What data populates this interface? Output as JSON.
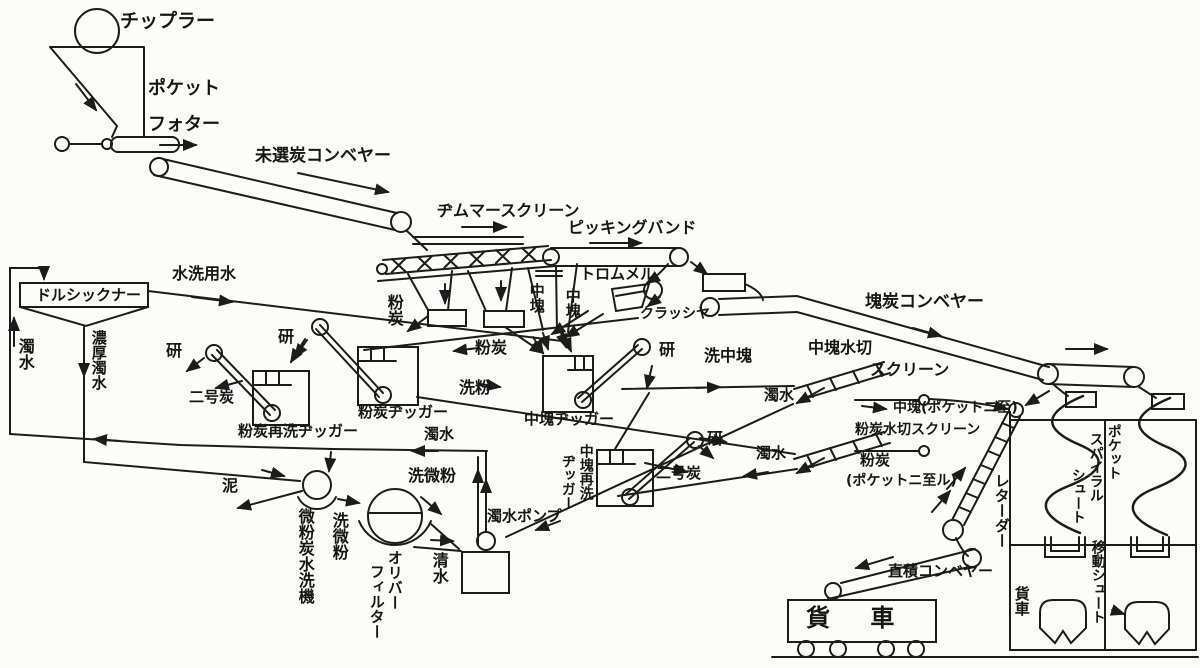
{
  "labels": {
    "tippler": "チップラー",
    "pocket": "ポケット",
    "feeder": "フォター",
    "raw_coal_conveyor": "未選炭コンベヤー",
    "zimmer_screen": "ヂムマースクリーン",
    "picking_band": "ピッキングバンド",
    "trommel": "トロムメル",
    "crusher": "クラッシヤ",
    "lump_coal_conveyor": "塊炭コンベヤー",
    "wash_water": "水洗用水",
    "dorr_thickener": "ドルシックナー",
    "muddy_water_left": "濁水",
    "thick_muddy_water": "濃厚濁水",
    "fine_coal_chute": "粉炭",
    "medium_lump_1": "中塊",
    "medium_lump_2": "中塊",
    "refuse_1": "研",
    "refuse_2": "研",
    "refuse_3": "研",
    "refuse_4": "研",
    "no2_coal_left": "二号炭",
    "no2_coal_center": "二号炭",
    "fine_coal_rewash_jig": "粉炭再洗ヂッガー",
    "fine_coal_jig": "粉炭ヂッガー",
    "medium_lump_jig": "中塊ヂッガー",
    "medium_rewash_jig_l1": "中塊再洗",
    "medium_rewash_jig_l2": "ヂッガー",
    "fine_coal_stream": "粉炭",
    "washed_fines": "洗粉",
    "muddy_water_center": "濁水",
    "washed_medium_lump": "洗中塊",
    "medium_dewater_screen_l1": "中塊水切",
    "medium_dewater_screen_l2": "スクリーン",
    "muddy_water_upper": "濁水",
    "medium_to_pocket": "中塊(ポケットニ至)",
    "fine_dewater_screen": "粉炭水切スクリーン",
    "muddy_water_lower": "濁水",
    "fine_to_pocket_l1": "粉炭",
    "fine_to_pocket_l2": "(ポケットニ至ル)",
    "retarder": "レターダー",
    "spiral_l1": "ポケット",
    "spiral_l2": "スパイラル",
    "spiral_l3": "シュート",
    "moving_chute": "移動シュート",
    "freight_car_right": "貨車",
    "freight_car_bottom": "貨 車",
    "direct_loading_conveyor": "直積コンベヤー",
    "mud": "泥",
    "fine_powder_washer": "微粉炭水洗機",
    "washed_fine_powder_v": "洗微粉",
    "washed_fine_powder_h": "洗微粉",
    "oliver_filter_l1": "オリバー",
    "oliver_filter_l2": "フィルター",
    "clean_water": "清水",
    "muddy_water_pump": "濁水ポンプ"
  },
  "colors": {
    "ink": "#1c1c1c",
    "paper": "#fcfcfa"
  }
}
